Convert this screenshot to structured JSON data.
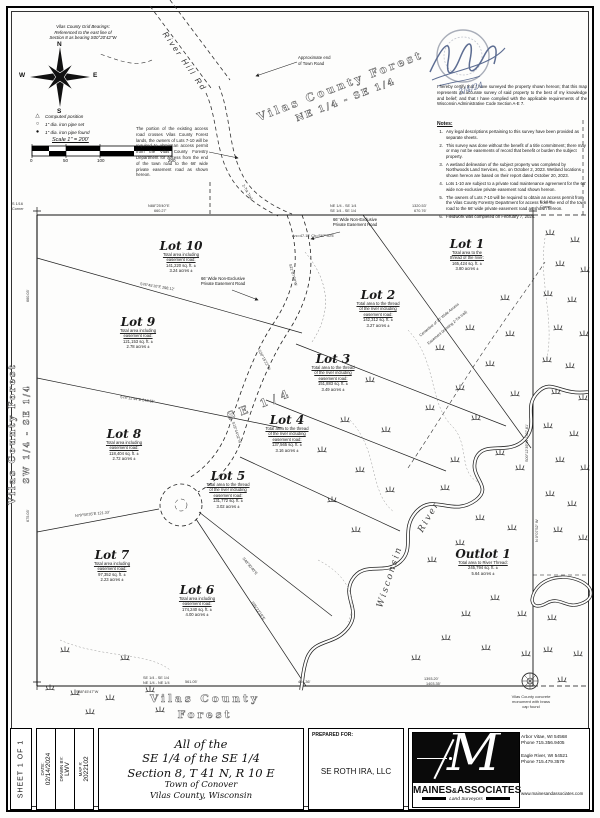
{
  "header": {
    "grid_note": [
      "Vilas County Grid Bearings:",
      "Referenced to the east line of",
      "Section 8 as bearing S00°20'42\"W"
    ],
    "compass": {
      "n": "N",
      "e": "E",
      "s": "S",
      "w": "W"
    },
    "legend": [
      {
        "symbol": "△",
        "label": "Computed position"
      },
      {
        "symbol": "○",
        "label": "1\" dia. iron pipe set"
      },
      {
        "symbol": "●",
        "label": "1\" dia. iron pipe found"
      }
    ],
    "scale_label": "Scale 1\" = 200'",
    "scale_ticks": [
      "0",
      "50",
      "100",
      "200"
    ],
    "road_label": "River Hill Rd",
    "approx_end_note": [
      "Approximate end",
      "of Town Road"
    ],
    "access_note": "The portion of the existing access road crosses Vilas County Forest lands, the owners of Lots 7-10 will be required to obtain an access permit from the Vilas County Forestry Department for access from the end of the town road to the 66' wide private easement road as shown hereon.",
    "certification": "I hereby certify that I have surveyed the property shown hereon; that this map represents an accurate survey of said property to the best of my knowledge and belief; and that I have complied with the applicable requirements of the Wisconsin Administrative Code Section A-E 7.",
    "seal_date": "3/4/24",
    "notes_title": "Notes:",
    "notes": [
      "Any legal descriptions pertaining to this survey have been provided as separate sheets.",
      "This survey was done without the benefit of a title commitment; there may or may not be easements of record that benefit or burden the subject property.",
      "A wetland delineation of the subject property was completed by Northwoods Land Services, Inc. on October 2, 2023. Wetland locations shown hereon are based on their report dated October 20, 2023.",
      "Lots 1-10 are subject to a private road maintenance agreement for the 66' wide non-exclusive private easement road shown hereon.",
      "The owners of Lots 7-10 will be required to obtain an access permit from the Vilas County Forestry Department for access from the end of the town road to the 66' wide private easement road as shown hereon.",
      "Fieldwork was completed on February 7, 2024."
    ]
  },
  "map": {
    "quarter_label": "SE 1/4",
    "forest_ne": [
      "Vilas County Forest",
      "NE 1/4 - SE 1/4"
    ],
    "forest_sw": [
      "Vilas County Forest",
      "SW 1/4 - SE 1/4"
    ],
    "forest_south": [
      "Vilas County",
      "Forest"
    ],
    "river_label": [
      "Wisconsin",
      "River"
    ],
    "easement_label": [
      "66' Wide Non-Exclusive",
      "Private Easement Road"
    ],
    "monument_note": [
      "Vilas County concrete",
      "monument with brass",
      "cap found"
    ],
    "corner_labels": [
      {
        "lines": [
          "S 1/16",
          "Corner"
        ],
        "x": 12,
        "y": 202
      },
      {
        "lines": [
          "E 1/16",
          "Corner"
        ],
        "x": 540,
        "y": 200
      },
      {
        "lines": [
          "NE 1/4 - SE 1/4",
          "SE 1/4 - SE 1/4"
        ],
        "x": 330,
        "y": 204
      },
      {
        "lines": [
          "SE 1/4 - SE 1/4",
          "NE 1/4 - NE 1/4"
        ],
        "x": 143,
        "y": 676
      }
    ],
    "lots": [
      {
        "name": "Lot 1",
        "x": 467,
        "y": 246,
        "u": 2,
        "lines": [
          "Total area to the",
          "thread of the river:",
          "165,424 sq. ft. ±",
          "3.80 acres ±"
        ]
      },
      {
        "name": "Lot 2",
        "x": 378,
        "y": 297,
        "u": 3,
        "lines": [
          "Total area to the thread",
          "of the river including",
          "easement road:",
          "142,312 sq. ft. ±",
          "3.27 acres ±"
        ]
      },
      {
        "name": "Lot 3",
        "x": 333,
        "y": 361,
        "u": 3,
        "lines": [
          "Total area to the thread",
          "of the river including",
          "easement road:",
          "151,883 sq. ft. ±",
          "3.49 acres ±"
        ]
      },
      {
        "name": "Lot 4",
        "x": 287,
        "y": 422,
        "u": 3,
        "lines": [
          "Total area to the thread",
          "of the river including",
          "easement road:",
          "137,565 sq. ft. ±",
          "3.16 acres ±"
        ]
      },
      {
        "name": "Lot 5",
        "x": 228,
        "y": 478,
        "u": 3,
        "lines": [
          "Total area to the thread",
          "of the river including",
          "easement road:",
          "131,772 sq. ft. ±",
          "3.02 acres ±"
        ]
      },
      {
        "name": "Lot 6",
        "x": 197,
        "y": 592,
        "u": 2,
        "lines": [
          "Total area including",
          "easement road:",
          "174,240 sq. ft. ±",
          "4.00 acres ±"
        ]
      },
      {
        "name": "Lot 7",
        "x": 112,
        "y": 557,
        "u": 2,
        "lines": [
          "Total area including",
          "easement road:",
          "97,352 sq. ft. ±",
          "2.23 acres ±"
        ]
      },
      {
        "name": "Lot 8",
        "x": 124,
        "y": 436,
        "u": 2,
        "lines": [
          "Total area including",
          "easement road:",
          "118,404 sq. ft. ±",
          "2.72 acres ±"
        ]
      },
      {
        "name": "Lot 9",
        "x": 138,
        "y": 324,
        "u": 2,
        "lines": [
          "Total area including",
          "easement road:",
          "121,153 sq. ft. ±",
          "2.78 acres ±"
        ]
      },
      {
        "name": "Lot 10",
        "x": 181,
        "y": 248,
        "u": 2,
        "lines": [
          "Total area including",
          "easement road:",
          "141,220 sq. ft. ±",
          "3.24 acres ±"
        ]
      },
      {
        "name": "Outlot 1",
        "x": 483,
        "y": 556,
        "u": 1,
        "lines": [
          "Total area to River Thread:",
          "245,794 sq. ft. ±",
          "5.64 acres ±"
        ]
      }
    ],
    "bearings": [
      {
        "t": "N88°25'40\"E",
        "x": 148,
        "y": 204,
        "r": 0
      },
      {
        "t": "660.27'",
        "x": 154,
        "y": 209,
        "r": 0
      },
      {
        "t": "1320.53'",
        "x": 412,
        "y": 204,
        "r": 0
      },
      {
        "t": "670.76'",
        "x": 414,
        "y": 209,
        "r": 0
      },
      {
        "t": "660.03'",
        "x": 28,
        "y": 300,
        "r": -90
      },
      {
        "t": "675.03'",
        "x": 28,
        "y": 520,
        "r": -90
      },
      {
        "t": "S00°12'39\"W 1327.81'",
        "x": 527,
        "y": 460,
        "r": -90
      },
      {
        "t": "N 0°07'52\" W",
        "x": 537,
        "y": 540,
        "r": -90
      },
      {
        "t": "S88°45'47\"W",
        "x": 76,
        "y": 690,
        "r": 0
      },
      {
        "t": "561.05'",
        "x": 185,
        "y": 680,
        "r": 0
      },
      {
        "t": "404.36'",
        "x": 298,
        "y": 680,
        "r": 0
      },
      {
        "t": "1393.20'",
        "x": 424,
        "y": 677,
        "r": 0
      },
      {
        "t": "1403.35'",
        "x": 426,
        "y": 682,
        "r": 0
      },
      {
        "t": "S21°07'38\"W",
        "x": 290,
        "y": 262,
        "r": 75
      },
      {
        "t": "S30°15'22\"W",
        "x": 259,
        "y": 348,
        "r": 62
      },
      {
        "t": "S19°44'02\"W",
        "x": 233,
        "y": 420,
        "r": 72
      },
      {
        "t": "S76°45'10\"E  298.12'",
        "x": 140,
        "y": 282,
        "r": 9
      },
      {
        "t": "S78°12'44\"E  243.65'",
        "x": 120,
        "y": 395,
        "r": 8
      },
      {
        "t": "N79°58'35\"E  121.33'",
        "x": 75,
        "y": 514,
        "r": -6
      },
      {
        "t": "S48°30'40\"E",
        "x": 243,
        "y": 556,
        "r": 50
      },
      {
        "t": "S35°22'18\"E",
        "x": 252,
        "y": 600,
        "r": 55
      },
      {
        "t": "Centerline of 30' Wide Access",
        "x": 420,
        "y": 334,
        "r": -40
      },
      {
        "t": "Easement (existing 2-Trk trail)",
        "x": 428,
        "y": 342,
        "r": -40
      },
      {
        "t": "2-Trk Trail",
        "x": 243,
        "y": 183,
        "r": 60
      },
      {
        "t": "Arc=47.13'  Ch=S67°30'E",
        "x": 292,
        "y": 234,
        "r": 0
      }
    ]
  },
  "title_block": {
    "sheet_label": "SHEET 1 OF 1",
    "meta": [
      {
        "label": "DATE:",
        "value": "02/14/2024"
      },
      {
        "label": "DRAWN BY:",
        "value": "LWV"
      },
      {
        "label": "MAP #:",
        "value": "2022102"
      }
    ],
    "title_lines": [
      "All of the",
      "SE 1/4 of the SE 1/4",
      "Section 8, T 41 N, R 10 E",
      "Town of Conover",
      "Vilas County, Wisconsin"
    ],
    "prepared_label": "PREPARED FOR:",
    "client": "SE ROTH IRA, LLC",
    "firm": {
      "logo_letter": "M",
      "name_a": "MAINES",
      "amp": "&",
      "name_b": "ASSOCIATES",
      "tagline": "Land Surveyors",
      "addresses": [
        {
          "line1": "Arbor Vitae, WI 54568",
          "line2": "Phone 715.356.9405"
        },
        {
          "line1": "Eagle River, WI 54521",
          "line2": "Phone 715.479.3579"
        }
      ],
      "website": "www.mainesandassociates.com"
    }
  }
}
